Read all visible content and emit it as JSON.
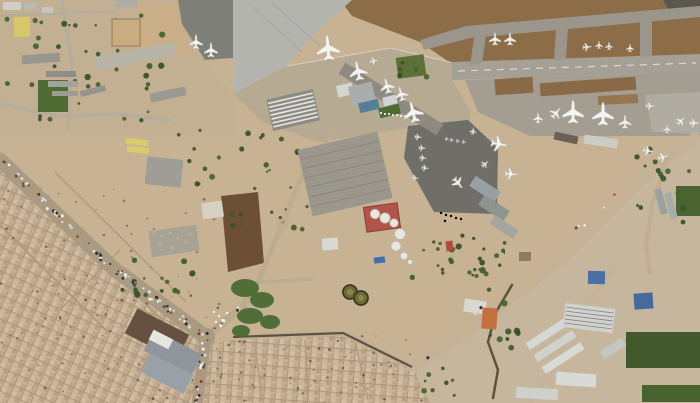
{
  "scene": {
    "description": "satellite-photo-of-airport-and-city",
    "width": 700,
    "height": 403,
    "base_color": "#c7b294"
  },
  "palette": {
    "terrain_tan": "#c7b294",
    "dirt_brown": "#8d6c48",
    "field_dark": "#6d4f35",
    "pavement_light": "#b4b4ae",
    "pavement_mid": "#a39d92",
    "pavement_dark": "#6f6e69",
    "city_tan": "#c8b297",
    "green_dark": "#42592e",
    "tree_green": "#3f5a2b",
    "tank_red": "#b2544a",
    "roof_blue": "#4a6fa5",
    "roof_orange": "#c2703d",
    "aircraft_white": "#f4f4f0"
  },
  "terrain": [
    {
      "name": "campus-ground",
      "points": "0,0 180,0 205,60 233,96 233,135 0,135",
      "fill": "#c3b093"
    },
    {
      "name": "dirt-field-north",
      "points": "340,0 663,0 669,9 700,8 700,56 455,66 420,42 352,16",
      "fill": "#8d6c48"
    },
    {
      "name": "runway-corner-dark",
      "points": "663,0 700,0 700,10 668,9",
      "fill": "#59574f"
    },
    {
      "name": "industrial-ground",
      "points": "412,367 470,330 560,260 640,180 668,158 695,136 700,134 700,403 432,403",
      "fill": "#c6b69e"
    },
    {
      "name": "plowed-field",
      "points": "221,196 258,192 264,263 228,272",
      "fill": "#6d4f35"
    },
    {
      "name": "sand-lot",
      "points": "138,2 186,4 187,54 140,48",
      "fill": "#c9ae88"
    }
  ],
  "pavements": [
    {
      "name": "apron-west",
      "points": "178,0 233,0 233,58 205,60 182,24",
      "fill": "#7f7f7a"
    },
    {
      "name": "apron-northwest",
      "points": "233,0 352,0 312,36 286,66 233,94",
      "fill": "#b4b4ae"
    },
    {
      "name": "terminal-apron",
      "points": "233,94 286,66 390,48 452,62 452,80 470,110 470,124 408,128 318,142 262,122",
      "fill": "#b7aa93"
    },
    {
      "name": "taxiway-north",
      "points": "420,40 466,26 700,6 700,17 470,38 424,50",
      "fill": "#9a968c"
    },
    {
      "name": "runway",
      "points": "452,62 700,54 700,72 452,80",
      "fill": "#a5a096"
    },
    {
      "name": "taxiway-connector",
      "points": "474,38 486,36 482,63 470,65",
      "fill": "#9a968c"
    },
    {
      "name": "taxiway-connector",
      "points": "556,30 568,28 566,59 554,60",
      "fill": "#9a968c"
    },
    {
      "name": "taxiway-connector",
      "points": "640,22 652,20 652,56 640,57",
      "fill": "#9a968c"
    },
    {
      "name": "apron-east",
      "points": "465,80 700,72 700,136 530,136 478,112",
      "fill": "#a39d92"
    },
    {
      "name": "apron-east-far",
      "points": "645,95 700,92 700,134 652,132",
      "fill": "#b0aca1"
    },
    {
      "name": "apron-military-dark",
      "points": "408,126 468,120 498,148 497,214 434,212 404,158",
      "fill": "#6f6e69"
    }
  ],
  "patches": [
    {
      "name": "dirt-patch",
      "x": 495,
      "y": 78,
      "w": 38,
      "h": 16,
      "rot": -4,
      "fill": "#8a6a46"
    },
    {
      "name": "dirt-patch",
      "x": 540,
      "y": 80,
      "w": 96,
      "h": 13,
      "rot": -4,
      "fill": "#8a6a46"
    },
    {
      "name": "dirt-patch",
      "x": 598,
      "y": 95,
      "w": 40,
      "h": 9,
      "rot": -3,
      "fill": "#97764f"
    }
  ],
  "lines": [
    {
      "name": "runway-centerline",
      "x1": 458,
      "y1": 71,
      "x2": 696,
      "y2": 63,
      "w": 1.2,
      "color": "#ded8ca",
      "dash": "7 6"
    },
    {
      "name": "apron-edge-line",
      "x1": 287,
      "y1": 66,
      "x2": 390,
      "y2": 48,
      "w": 1,
      "color": "#d6d0c2",
      "dash": ""
    },
    {
      "name": "apron-edge-line",
      "x1": 390,
      "y1": 48,
      "x2": 450,
      "y2": 62,
      "w": 1,
      "color": "#d6d0c2",
      "dash": ""
    },
    {
      "name": "taxi-lane",
      "x1": 342,
      "y1": 68,
      "x2": 440,
      "y2": 130,
      "w": 13,
      "color": "#8e8a81",
      "dash": ""
    },
    {
      "name": "apron-lane",
      "x1": 252,
      "y1": 6,
      "x2": 302,
      "y2": 52,
      "w": 1,
      "color": "#a6a6a0",
      "dash": ""
    },
    {
      "name": "apron-lane",
      "x1": 272,
      "y1": 3,
      "x2": 320,
      "y2": 46,
      "w": 1,
      "color": "#a6a6a0",
      "dash": ""
    }
  ],
  "roads": [
    {
      "name": "main-avenue",
      "pts": "0,160 113,268 206,337",
      "w": 15,
      "color": "#ab9a82"
    },
    {
      "name": "avenue-south-branch",
      "pts": "206,337 197,403",
      "w": 11,
      "color": "#ab9a82"
    },
    {
      "name": "airport-gate-road",
      "pts": "206,337 243,307",
      "w": 7,
      "color": "#b3a28b"
    },
    {
      "name": "perimeter-road",
      "pts": "233,337 343,333 412,367",
      "w": 6,
      "color": "#c2b095"
    },
    {
      "name": "diagonal-highway",
      "pts": "412,367 470,330 560,260 640,180 668,158 695,137",
      "w": 10,
      "color": "#c4b196"
    },
    {
      "name": "east-branch-road",
      "pts": "668,158 652,205 646,248 650,272",
      "w": 4,
      "color": "#bfae92"
    },
    {
      "name": "industrial-road",
      "pts": "530,403 572,330 612,268",
      "w": 5,
      "color": "#c6b49a"
    },
    {
      "name": "campus-road",
      "pts": "0,104 58,116 118,114 170,120",
      "w": 3.5,
      "color": "#b6ac9a"
    },
    {
      "name": "campus-road",
      "pts": "62,2 72,62 68,128",
      "w": 3.5,
      "color": "#b6ac9a"
    },
    {
      "name": "terminal-access-road",
      "pts": "335,128 300,180 283,222 258,282 242,306 212,336",
      "w": 5,
      "color": "#bdab8e"
    },
    {
      "name": "cross-road",
      "pts": "233,284 312,279",
      "w": 3.5,
      "color": "#bdab8e"
    },
    {
      "name": "canal",
      "pts": "512,285 496,312 488,342 498,370 493,398",
      "w": 2.5,
      "color": "#5a5438"
    },
    {
      "name": "top-street",
      "pts": "0,16 115,11",
      "w": 2.5,
      "color": "#b6ac9a"
    }
  ],
  "wall": {
    "name": "perimeter-wall",
    "pts": "233,337 343,333 412,367",
    "w": 2.2,
    "color": "#5d5243"
  },
  "city": [
    {
      "name": "city-southwest",
      "points": "0,170 36,182 125,275 206,337 233,352 233,403 0,403",
      "pattern": "cityA"
    },
    {
      "name": "city-south",
      "points": "196,403 202,346 233,340 345,334 412,368 430,403",
      "pattern": "cityB"
    }
  ],
  "city_streets": [
    {
      "x1": 22,
      "y1": 182,
      "x2": 160,
      "y2": 318,
      "w": 2
    },
    {
      "x1": 0,
      "y1": 225,
      "x2": 108,
      "y2": 332,
      "w": 2
    },
    {
      "x1": 55,
      "y1": 172,
      "x2": 186,
      "y2": 302,
      "w": 1.5
    },
    {
      "x1": 120,
      "y1": 250,
      "x2": 60,
      "y2": 310,
      "w": 1.5
    },
    {
      "x1": 160,
      "y1": 290,
      "x2": 110,
      "y2": 350,
      "w": 1.5
    },
    {
      "x1": 255,
      "y1": 345,
      "x2": 262,
      "y2": 400,
      "w": 1.5
    },
    {
      "x1": 305,
      "y1": 340,
      "x2": 308,
      "y2": 400,
      "w": 1.5
    },
    {
      "x1": 355,
      "y1": 340,
      "x2": 368,
      "y2": 400,
      "w": 1.5
    }
  ],
  "greens": [
    {
      "name": "sports-field",
      "x": 38,
      "y": 80,
      "w": 30,
      "h": 32,
      "rot": 0,
      "fill": "#4f6c35"
    },
    {
      "name": "airfield-lawn",
      "x": 397,
      "y": 56,
      "w": 28,
      "h": 21,
      "rot": -8,
      "fill": "#5c7038"
    },
    {
      "name": "terminal-lawn",
      "x": 379,
      "y": 106,
      "w": 21,
      "h": 10,
      "rot": -13,
      "fill": "#4e6a33"
    },
    {
      "name": "farm-field",
      "x": 626,
      "y": 332,
      "w": 74,
      "h": 36,
      "rot": 0,
      "fill": "#42592e"
    },
    {
      "name": "farm-field",
      "x": 642,
      "y": 385,
      "w": 58,
      "h": 17,
      "rot": 0,
      "fill": "#49632f"
    },
    {
      "name": "farm-field",
      "x": 676,
      "y": 186,
      "w": 24,
      "h": 30,
      "rot": 0,
      "fill": "#4a6331"
    }
  ],
  "green_blobs": [
    {
      "cx": 245,
      "cy": 288,
      "rx": 14,
      "ry": 9
    },
    {
      "cx": 262,
      "cy": 300,
      "rx": 12,
      "ry": 8
    },
    {
      "cx": 250,
      "cy": 316,
      "rx": 13,
      "ry": 8
    },
    {
      "cx": 270,
      "cy": 322,
      "rx": 10,
      "ry": 7
    },
    {
      "cx": 241,
      "cy": 331,
      "rx": 9,
      "ry": 6
    }
  ],
  "tree_clusters": [
    {
      "x": 4,
      "y": 4,
      "w": 160,
      "h": 122,
      "n": 40
    },
    {
      "x": 176,
      "y": 128,
      "w": 56,
      "h": 56,
      "n": 9
    },
    {
      "x": 232,
      "y": 130,
      "w": 78,
      "h": 100,
      "n": 24
    },
    {
      "x": 398,
      "y": 54,
      "w": 30,
      "h": 24,
      "n": 6
    },
    {
      "x": 408,
      "y": 228,
      "w": 70,
      "h": 52,
      "n": 18
    },
    {
      "x": 636,
      "y": 146,
      "w": 54,
      "h": 84,
      "n": 16
    },
    {
      "x": 112,
      "y": 258,
      "w": 88,
      "h": 38,
      "n": 16
    },
    {
      "x": 470,
      "y": 238,
      "w": 56,
      "h": 36,
      "n": 12
    },
    {
      "x": 424,
      "y": 366,
      "w": 36,
      "h": 30,
      "n": 8
    },
    {
      "x": 482,
      "y": 286,
      "w": 36,
      "h": 62,
      "n": 10
    }
  ],
  "speckle_areas": [
    {
      "x": 0,
      "y": 180,
      "w": 220,
      "h": 220,
      "n": 130
    },
    {
      "x": 210,
      "y": 336,
      "w": 215,
      "h": 66,
      "n": 70
    }
  ],
  "buildings": [
    [
      3,
      2,
      18,
      8,
      0,
      "#cfcfc6"
    ],
    [
      24,
      3,
      13,
      7,
      0,
      "#b9b9b1"
    ],
    [
      42,
      7,
      11,
      6,
      0,
      "#c6c6be"
    ],
    [
      14,
      17,
      16,
      20,
      0,
      "#d8c76a"
    ],
    [
      116,
      0,
      22,
      7,
      0,
      "#adada5"
    ],
    [
      22,
      54,
      38,
      9,
      -4,
      "#97978f"
    ],
    [
      94,
      50,
      82,
      13,
      -11,
      "#b8b3a7"
    ],
    [
      46,
      71,
      30,
      6,
      0,
      "#8e8e86"
    ],
    [
      48,
      81,
      30,
      6,
      0,
      "#a3a39b"
    ],
    [
      80,
      88,
      26,
      6,
      -14,
      "#94948c"
    ],
    [
      52,
      91,
      26,
      5,
      0,
      "#9c9c94"
    ],
    [
      150,
      90,
      36,
      9,
      -12,
      "#9a9a91"
    ],
    [
      112,
      19,
      28,
      27,
      0,
      "#c9ac80",
      "outline"
    ],
    [
      126,
      139,
      22,
      6,
      6,
      "#d9cc6c"
    ],
    [
      127,
      147,
      22,
      6,
      6,
      "#d9cc6c"
    ],
    [
      146,
      158,
      36,
      28,
      6,
      "#9e9e96"
    ],
    [
      202,
      202,
      21,
      16,
      -8,
      "#d7d1c1"
    ],
    [
      150,
      228,
      48,
      26,
      -8,
      "#a8a295"
    ],
    [
      269,
      94,
      48,
      32,
      -13,
      "#8c8c84",
      "stripes:7"
    ],
    [
      337,
      84,
      16,
      12,
      -13,
      "#d3d5d2"
    ],
    [
      350,
      84,
      24,
      20,
      -13,
      "#a9aeac"
    ],
    [
      359,
      101,
      20,
      10,
      -13,
      "#567e98"
    ],
    [
      383,
      96,
      14,
      9,
      -13,
      "#cfd3d6"
    ],
    [
      304,
      140,
      82,
      68,
      -13,
      "#9c978c",
      "lanes:6"
    ],
    [
      322,
      238,
      16,
      12,
      -5,
      "#d9d9d3"
    ],
    [
      554,
      134,
      24,
      8,
      12,
      "#6b6055"
    ],
    [
      584,
      137,
      34,
      9,
      8,
      "#ccccc4"
    ],
    [
      470,
      183,
      30,
      12,
      33,
      "#99a0a4"
    ],
    [
      479,
      202,
      30,
      12,
      33,
      "#8e958f"
    ],
    [
      490,
      222,
      28,
      10,
      33,
      "#a4a7a1"
    ],
    [
      505,
      248,
      10,
      8,
      0,
      "#c7b497"
    ],
    [
      519,
      252,
      12,
      9,
      0,
      "#8d7a5f"
    ],
    [
      648,
      198,
      26,
      7,
      75,
      "#9aa19f"
    ],
    [
      658,
      202,
      26,
      7,
      75,
      "#a6aca9"
    ],
    [
      128,
      320,
      58,
      28,
      27,
      "#66503f"
    ],
    [
      146,
      341,
      54,
      23,
      27,
      "#8e969b"
    ],
    [
      143,
      363,
      48,
      21,
      27,
      "#99a1a6"
    ],
    [
      150,
      334,
      22,
      11,
      27,
      "#e6e6e0"
    ],
    [
      464,
      300,
      22,
      13,
      8,
      "#d8d8d1"
    ],
    [
      482,
      308,
      15,
      21,
      4,
      "#c2703d"
    ],
    [
      524,
      330,
      46,
      8,
      -33,
      "#d6d8d4"
    ],
    [
      532,
      342,
      46,
      8,
      -33,
      "#cfd2cd"
    ],
    [
      540,
      354,
      46,
      8,
      -33,
      "#d8dad6"
    ],
    [
      564,
      306,
      50,
      24,
      7,
      "#d0d2cf",
      "lanes:5"
    ],
    [
      588,
      271,
      17,
      13,
      2,
      "#4a6fa5"
    ],
    [
      634,
      293,
      19,
      16,
      -4,
      "#48699c"
    ],
    [
      556,
      373,
      40,
      13,
      4,
      "#d9dad5"
    ],
    [
      516,
      388,
      42,
      11,
      3,
      "#ced0cb"
    ],
    [
      600,
      344,
      26,
      9,
      -33,
      "#c3c6c1"
    ]
  ],
  "tank_farm": {
    "containment": {
      "x": 365,
      "y": 205,
      "w": 34,
      "h": 25,
      "rot": -8,
      "fill": "#b2544a",
      "stroke": "#8a3c34"
    },
    "white_tanks": [
      {
        "cx": 375,
        "cy": 214,
        "r": 4.8
      },
      {
        "cx": 385,
        "cy": 218,
        "r": 5.2
      },
      {
        "cx": 394,
        "cy": 223,
        "r": 4.2
      },
      {
        "cx": 400,
        "cy": 234,
        "r": 5.5
      },
      {
        "cx": 396,
        "cy": 246,
        "r": 5
      },
      {
        "cx": 404,
        "cy": 256,
        "r": 3.8
      },
      {
        "cx": 410,
        "cy": 262,
        "r": 2.5
      }
    ],
    "olive_tanks": [
      {
        "cx": 350,
        "cy": 292,
        "r": 7
      },
      {
        "cx": 361,
        "cy": 298,
        "r": 7
      }
    ],
    "pool": {
      "x": 374,
      "y": 257,
      "w": 11,
      "h": 6,
      "rot": -8,
      "fill": "#3f6fae"
    },
    "red_shed": {
      "x": 446,
      "y": 241,
      "w": 7,
      "h": 10,
      "rot": -8,
      "fill": "#b24a3e"
    }
  },
  "roundabout": {
    "cx": 283,
    "cy": 222,
    "r": 6.5,
    "fill": "#c0ae91",
    "center_fill": "#a99876"
  },
  "intersection": {
    "cx": 206,
    "cy": 337,
    "r": 9,
    "fill": "#ab9a82"
  },
  "dot_rows": [
    {
      "name": "ground-vehicles",
      "color": "#f0f0ea",
      "r": 1.1,
      "pts": [
        [
          381,
          113
        ],
        [
          385,
          114
        ],
        [
          389,
          114
        ],
        [
          393,
          115
        ],
        [
          397,
          115
        ],
        [
          401,
          116
        ],
        [
          405,
          116
        ]
      ]
    },
    {
      "name": "apron-vehicles",
      "color": "#ececе6",
      "r": 1.2,
      "pts": [
        [
          441,
          213
        ],
        [
          446,
          215
        ],
        [
          451,
          216
        ],
        [
          456,
          218
        ],
        [
          461,
          219
        ],
        [
          445,
          221
        ]
      ]
    },
    {
      "name": "bus-yard-vehicles",
      "color": "#f2f2ec",
      "r": 1.2,
      "pts": [
        [
          214,
          312
        ],
        [
          219,
          316
        ],
        [
          224,
          320
        ],
        [
          216,
          322
        ],
        [
          221,
          326
        ],
        [
          227,
          313
        ]
      ]
    },
    {
      "name": "equipment-clutter",
      "color": "#b9b4a8",
      "r": 1.3,
      "pts": [
        [
          155,
          232
        ],
        [
          162,
          236
        ],
        [
          170,
          233
        ],
        [
          178,
          238
        ],
        [
          186,
          242
        ],
        [
          160,
          245
        ],
        [
          172,
          248
        ],
        [
          190,
          234
        ]
      ]
    }
  ],
  "traffic": {
    "colors": [
      "#2e2e2e",
      "#f2f2f2",
      "#d8d8d8",
      "#555555",
      "#933b2d",
      "#dddddd",
      "#333333",
      "#eeeeee"
    ],
    "segments": [
      {
        "x1": 0,
        "y1": 160,
        "x2": 113,
        "y2": 268,
        "n": 38
      },
      {
        "x1": 113,
        "y1": 268,
        "x2": 206,
        "y2": 337,
        "n": 40
      },
      {
        "x1": 206,
        "y1": 337,
        "x2": 196,
        "y2": 403,
        "n": 22
      },
      {
        "x1": 206,
        "y1": 337,
        "x2": 240,
        "y2": 309,
        "n": 10
      },
      {
        "x1": 420,
        "y1": 362,
        "x2": 630,
        "y2": 185,
        "n": 8
      }
    ]
  },
  "aircraft": [
    [
      196,
      42,
      15,
      0
    ],
    [
      211,
      50,
      15,
      0
    ],
    [
      328,
      48,
      26,
      -5
    ],
    [
      358,
      71,
      20,
      -12
    ],
    [
      374,
      61,
      9,
      80
    ],
    [
      387,
      86,
      16,
      -14
    ],
    [
      401,
      94,
      15,
      -14
    ],
    [
      413,
      112,
      22,
      -14
    ],
    [
      495,
      39,
      13,
      0
    ],
    [
      510,
      39,
      13,
      0
    ],
    [
      587,
      47,
      9,
      85
    ],
    [
      599,
      45,
      8,
      0
    ],
    [
      609,
      46,
      8,
      0
    ],
    [
      630,
      48,
      8,
      0
    ],
    [
      538,
      118,
      11,
      0
    ],
    [
      556,
      113,
      13,
      40
    ],
    [
      573,
      112,
      24,
      0
    ],
    [
      603,
      114,
      24,
      0
    ],
    [
      625,
      122,
      14,
      0
    ],
    [
      650,
      106,
      9,
      90
    ],
    [
      667,
      129,
      9,
      0
    ],
    [
      681,
      121,
      10,
      45
    ],
    [
      694,
      123,
      10,
      90
    ],
    [
      499,
      144,
      17,
      100
    ],
    [
      511,
      174,
      13,
      95
    ],
    [
      648,
      151,
      11,
      100
    ],
    [
      663,
      157,
      11,
      75
    ],
    [
      418,
      137,
      7,
      95
    ],
    [
      422,
      148,
      7,
      95
    ],
    [
      423,
      158,
      7,
      95
    ],
    [
      425,
      168,
      7,
      95
    ],
    [
      415,
      178,
      7,
      95
    ],
    [
      458,
      183,
      13,
      140
    ],
    [
      485,
      164,
      8,
      50
    ],
    [
      473,
      131,
      7,
      10
    ],
    [
      447,
      139,
      4,
      100
    ],
    [
      452,
      140,
      4,
      100
    ],
    [
      458,
      141,
      4,
      100
    ],
    [
      464,
      142,
      4,
      100
    ]
  ]
}
